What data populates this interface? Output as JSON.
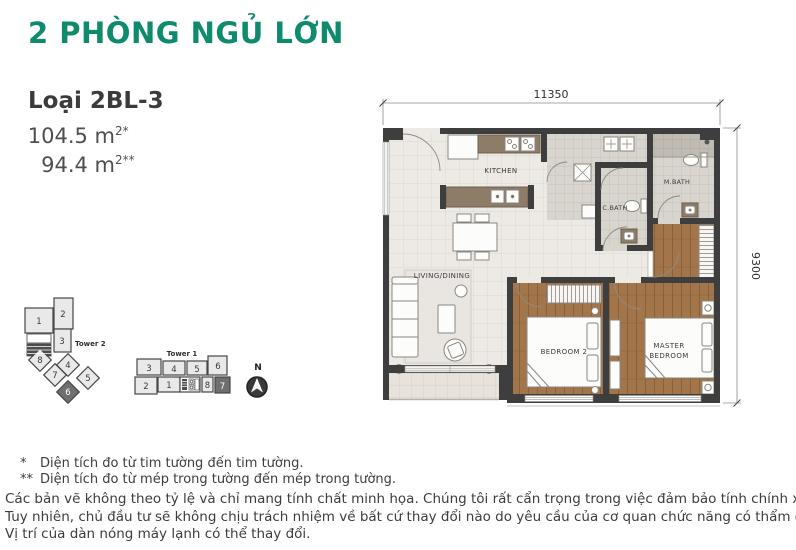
{
  "header": {
    "title": "2 PHÒNG NGỦ LỚN",
    "unit_type": "Loại 2BL-3",
    "area1_value": "104.5 m",
    "area1_sup": "2*",
    "area2_value": "94.4 m",
    "area2_sup": "2**"
  },
  "plan": {
    "dim_top": "11350",
    "dim_right": "9300",
    "rooms": {
      "kitchen": "KITCHEN",
      "living_dining": "LIVING/DINING",
      "bedroom2": "BEDROOM 2",
      "master_line1": "MASTER",
      "master_line2": "BEDROOM",
      "c_bath": "C.BATH",
      "m_bath": "M.BATH"
    }
  },
  "towers": {
    "tower2": {
      "label": "Tower 2",
      "units": [
        "1",
        "2",
        "3",
        "4",
        "5",
        "6",
        "7",
        "8"
      ],
      "highlighted_unit": "6"
    },
    "tower1": {
      "label": "Tower 1",
      "units_top": [
        "3",
        "4",
        "5",
        "6"
      ],
      "units_bottom": [
        "2",
        "1",
        "8",
        "7"
      ],
      "highlighted_unit": "7"
    }
  },
  "compass": {
    "north": "N"
  },
  "footnotes": {
    "note1_marker": "*",
    "note1": "Diện tích đo từ tim tường đến tim tường.",
    "note2_marker": "**",
    "note2": "Diện tích đo từ mép trong tường đến mép trong tường.",
    "disclaimer_line1": "Các bản vẽ không theo tỷ lệ và chỉ mang tính chất minh họa. Chúng tôi rất cẩn trọng trong việc đảm bảo tính chính xác của bản vẽ.",
    "disclaimer_line2": "Tuy nhiên, chủ đầu tư sẽ không chịu trách nhiệm về bất cứ thay đổi nào do yêu cầu của cơ quan chức năng có thẩm quyền.",
    "disclaimer_line3": "Vị trí của dàn nóng máy lạnh có thể thay đổi."
  },
  "colors": {
    "accent_green": "#0e8a6d",
    "wall": "#3f3e3e",
    "wood_floor": "#a2764a",
    "highlight_unit": "#6f6f6f"
  }
}
